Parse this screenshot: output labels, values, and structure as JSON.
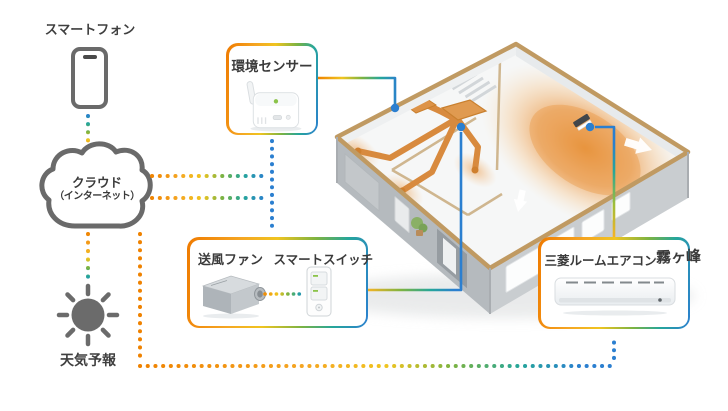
{
  "nodes": {
    "smartphone": {
      "label": "スマートフォン"
    },
    "cloud": {
      "line1": "クラウド",
      "line2": "（インターネット）"
    },
    "weather": {
      "label": "天気予報"
    },
    "sensor": {
      "label": "環境センサー"
    },
    "fan": {
      "label": "送風ファン"
    },
    "smart_switch": {
      "label": "スマートスイッチ"
    },
    "aircon": {
      "label": "三菱ルームエアコン",
      "logo": "霧ヶ峰"
    }
  },
  "palette": {
    "orange": "#ef8200",
    "amber": "#f5a623",
    "yellow": "#f0c420",
    "green": "#7cb342",
    "teal": "#26a69a",
    "blue": "#2b7fd0",
    "icon_gray": "#6a6a6a",
    "duct_orange": "#d88a3e",
    "heat_orange": "#e78f35",
    "wall_tan": "#c09a62",
    "text": "#3a3a3a"
  },
  "connections": [
    {
      "from": "smartphone",
      "to": "cloud",
      "style": "dotted-gradient"
    },
    {
      "from": "cloud",
      "to": "weather",
      "style": "dotted-gradient"
    },
    {
      "from": "cloud",
      "to": "sensor",
      "style": "dotted-gradient"
    },
    {
      "from": "cloud",
      "to": "fan_switch",
      "style": "dotted-gradient"
    },
    {
      "from": "cloud",
      "to": "aircon",
      "style": "dotted-gradient"
    },
    {
      "from": "fan",
      "to": "smart_switch",
      "style": "dotted-gradient"
    },
    {
      "from": "sensor",
      "to": "house",
      "style": "solid-callout"
    },
    {
      "from": "fan_switch",
      "to": "house",
      "style": "solid-callout"
    },
    {
      "from": "aircon",
      "to": "house",
      "style": "solid-callout"
    }
  ]
}
